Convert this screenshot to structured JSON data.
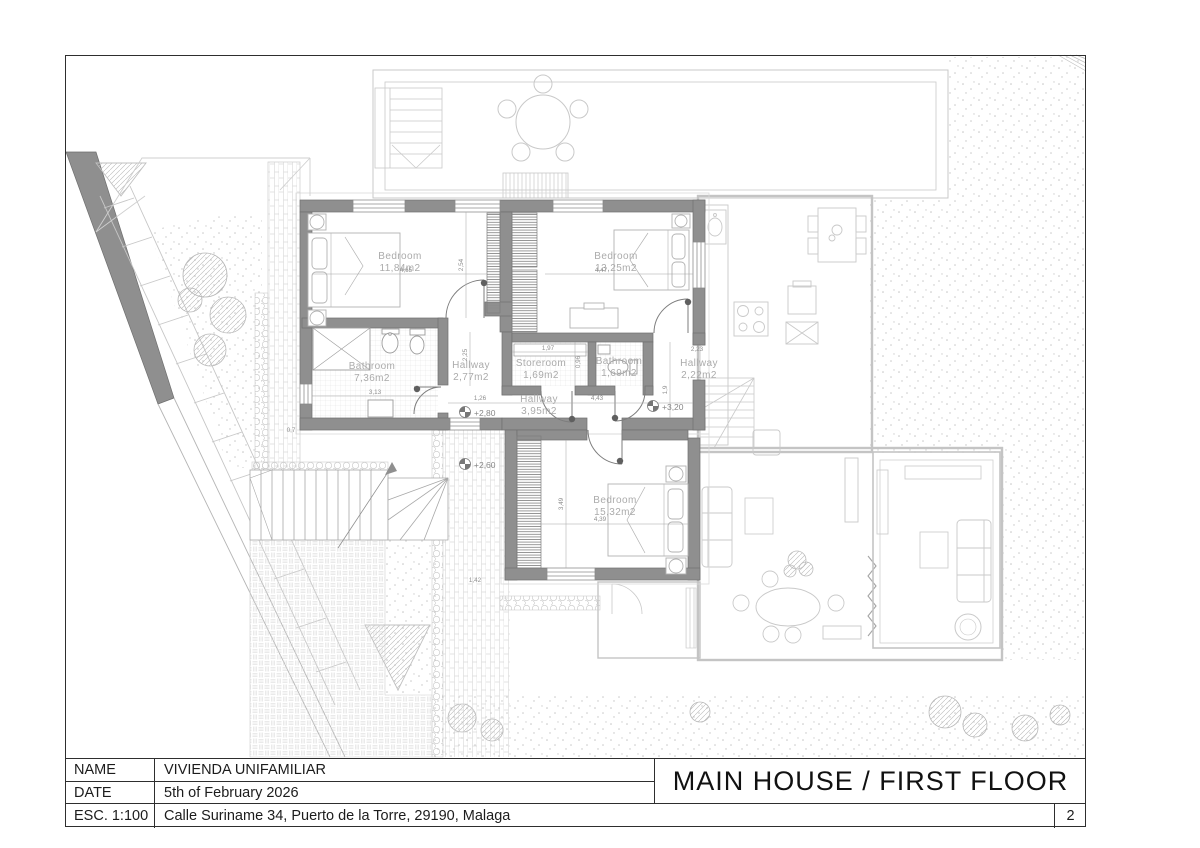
{
  "title_block": {
    "name_label": "NAME",
    "name_value": "VIVIENDA UNIFAMILIAR",
    "date_label": "DATE",
    "date_value": "5th of February 2026",
    "scale_label": "ESC. 1:100",
    "address": "Calle Suriname 34, Puerto de la Torre, 29190, Malaga",
    "sheet_title": "MAIN HOUSE  / FIRST FLOOR",
    "page_number": "2"
  },
  "plan": {
    "rooms": [
      {
        "name": "Bedroom",
        "area": "11,84m2"
      },
      {
        "name": "Bedroom",
        "area": "13,25m2"
      },
      {
        "name": "Bathroom",
        "area": "7,36m2"
      },
      {
        "name": "Hallway",
        "area": "2,77m2"
      },
      {
        "name": "Storeroom",
        "area": "1,69m2"
      },
      {
        "name": "Bathroom",
        "area": "1,69m2"
      },
      {
        "name": "Hallway",
        "area": "2,22m2"
      },
      {
        "name": "Hallway",
        "area": "3,95m2"
      },
      {
        "name": "Bedroom",
        "area": "15,32m2"
      }
    ],
    "levels": [
      "+2,80",
      "+3,20",
      "+2,60"
    ],
    "dims": [
      "4,65",
      "2,54",
      "4,47",
      "3,13",
      "2,25",
      "1,97",
      "0,96",
      "1,26",
      "4,43",
      "2,23",
      "1,9",
      "4,39",
      "3,49",
      "1,42",
      "0,7"
    ],
    "colors": {
      "wall": "#8f8f8f",
      "ground_lines": "#c9c9c9",
      "labels": "#ababab"
    }
  }
}
